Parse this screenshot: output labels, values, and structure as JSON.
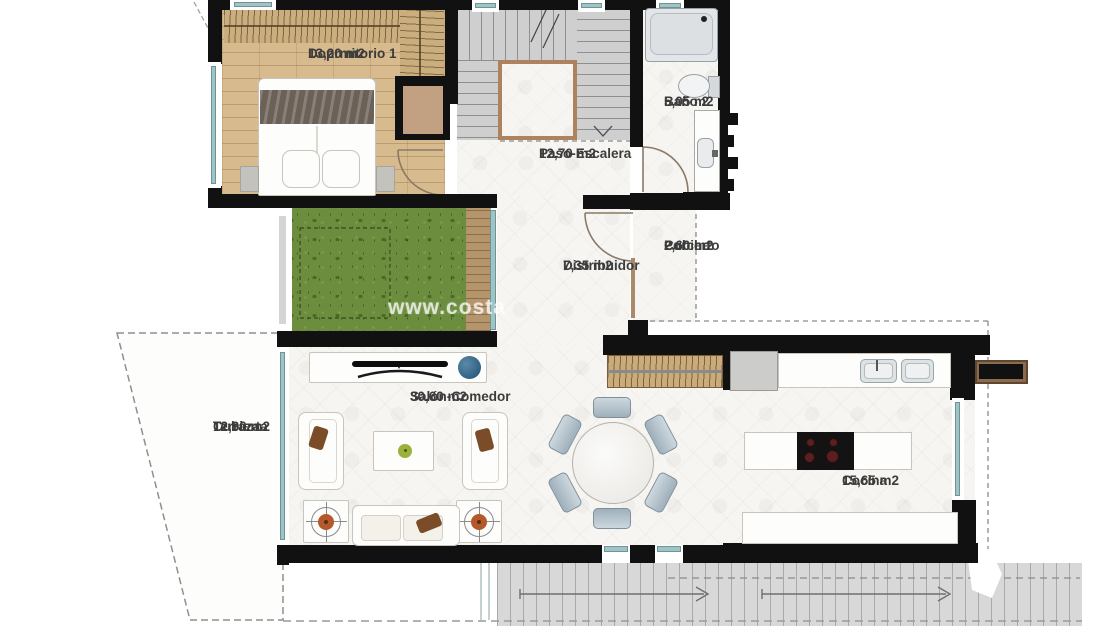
{
  "watermark": "www.costa",
  "rooms": [
    {
      "name": "Doprmitorio 1",
      "area": "13,20 m2"
    },
    {
      "name": "Paso-Escalera",
      "area": "12,70 m2"
    },
    {
      "name": "Baño 2",
      "area": "5,05 m2"
    },
    {
      "name": "Distribuidor",
      "area": "7,35 m2"
    },
    {
      "name_line1": "Porche",
      "name_line2": "Cubierto",
      "area": "2,60 m2"
    },
    {
      "name_line1": "Terraza",
      "name_line2": "Cubierta",
      "area": "12,90 m2"
    },
    {
      "name": "Salón-Comedor",
      "area": "30,60 m2"
    },
    {
      "name": "Cocina",
      "area": "15,65 m2"
    }
  ],
  "colors": {
    "wall": "#111111",
    "wood_floor": "#d7ba8d",
    "deck": "#b5956b",
    "grass": "#6c8d3e",
    "tile": "#f6f5f2",
    "stair": "#d6d6d6",
    "glass": "#9fc4c6",
    "speaker_blue": "#2f6183",
    "table_orange": "#b3592a",
    "apple_green": "#9ab23c",
    "beam_brown": "#8a6b4e"
  }
}
